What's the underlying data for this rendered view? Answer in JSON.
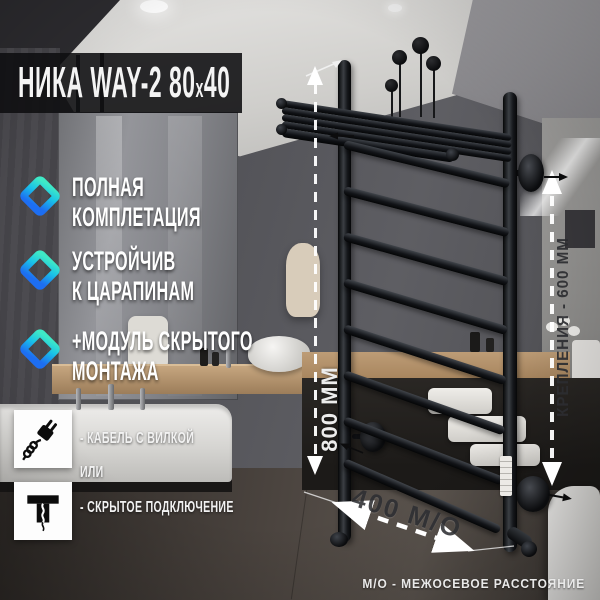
{
  "banner": {
    "title_part1": "НИКА WAY-2 80",
    "title_x": "х",
    "title_part2": "40"
  },
  "features": [
    {
      "icon": "diamond-gradient-icon",
      "label": "ПОЛНАЯ\nКОМПЛЕТАЦИЯ"
    },
    {
      "icon": "diamond-gradient-icon",
      "label": "УСТРОЙЧИВ\nК ЦАРАПИНАМ"
    },
    {
      "icon": "diamond-gradient-icon",
      "label": "+МОДУЛЬ СКРЫТОГО\nМОНТАЖА"
    }
  ],
  "connection": {
    "option_plug": "- КАБЕЛЬ С ВИЛКОЙ",
    "separator": "ИЛИ",
    "option_hidden": "- СКРЫТОЕ ПОДКЛЮЧЕНИЕ"
  },
  "dimensions": {
    "height": "800 ММ",
    "mount_spacing": "КРЕПЛЕНИЯ - 600 ММ",
    "width_axis": "400 М/О",
    "footnote": "М/О - МЕЖОСЕВОЕ РАССТОЯНИЕ"
  },
  "colors": {
    "accent_gradient_start": "#3fe9c6",
    "accent_gradient_mid": "#19c3e8",
    "accent_gradient_end": "#1d6ef2",
    "banner_bg": "#0e0e10",
    "rail_black": "#15171b",
    "dim_line_white": "#ffffff",
    "dim_text_dark": "#2e2f33"
  }
}
